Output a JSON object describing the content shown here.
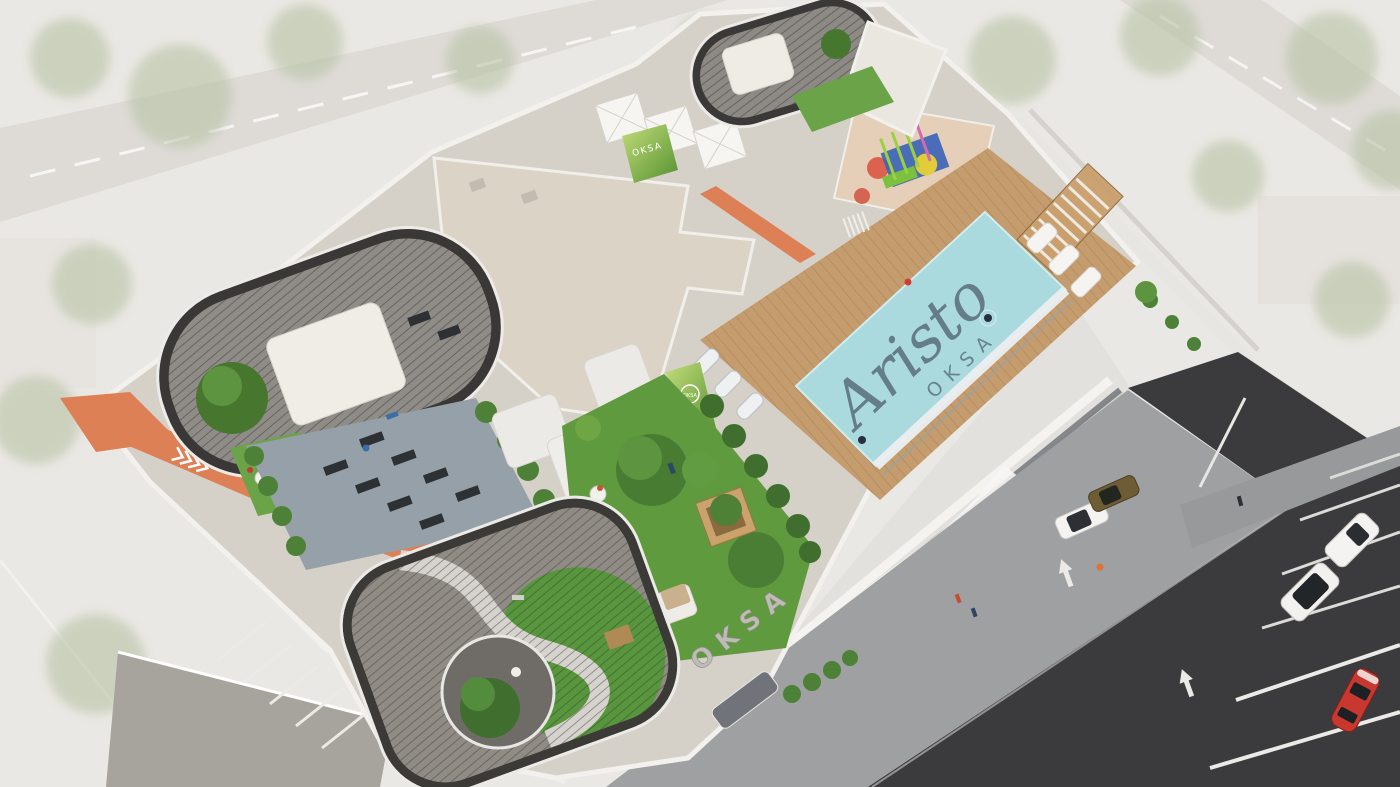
{
  "scene": {
    "description": "Aerial 3D architectural rendering of the Aristo by OKSA residential tower rooftop amenity deck, with swimming pool, jogging track, outdoor gym, pergola gardens, kids play area and surrounding streets with parked cars",
    "branding": {
      "pool_logo_primary": "Aristo",
      "pool_logo_secondary": "OKSA",
      "parapet_sign": "OKSA",
      "green_wall_sign_upper": "OKSA",
      "green_wall_sign_garden": "OKSA"
    },
    "colors": {
      "pool_water": "#aadade",
      "pool_logo": "#5d7480",
      "track_orange": "#dd8055",
      "lawn_green": "#5f9a3e",
      "grass_bright": "#57963c",
      "roof_concrete": "#d6d1c8",
      "cream_roof": "#dbd3c5",
      "road_asphalt": "#3b3b3d",
      "plaza_gray": "#9ea0a2",
      "sports_car_red": "#c8382f",
      "background_faded": "#eae8e4"
    }
  }
}
